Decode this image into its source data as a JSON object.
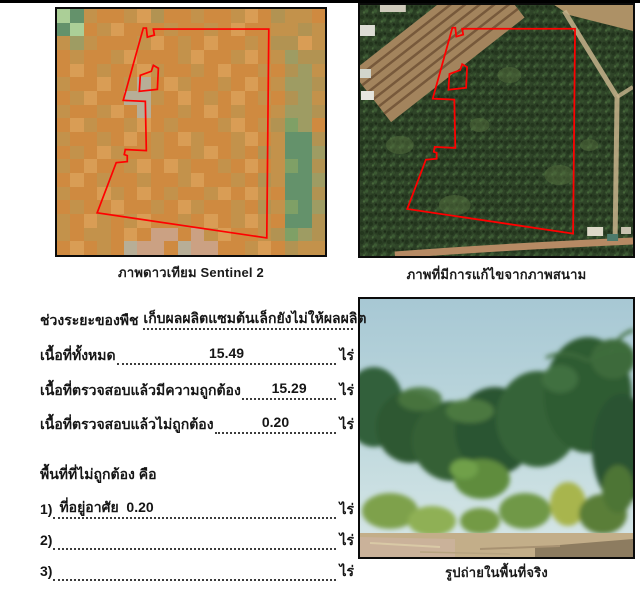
{
  "panels": {
    "satellite": {
      "caption": "ภาพดาวเทียม Sentinel 2",
      "polygon_color": "#ff0000",
      "mosaic": {
        "palette": [
          "#cf8a40",
          "#c3924b",
          "#b29352",
          "#9e9c63",
          "#7fa066",
          "#64926b",
          "#abcf97",
          "#cba183",
          "#b7ae97",
          "#d99d55"
        ],
        "rows": [
          "65100192001001902110",
          "56019000100109001121",
          "13100019010900102291",
          "01001900019001901322",
          "09010091001090010231",
          "10090180910010901332",
          "01900881090109010231",
          "10019080010901001332",
          "09100190100019012430",
          "10010901091001901552",
          "01091001001901021553",
          "10900190910010901452",
          "09010010019001021553",
          "10091090100190910552",
          "01009001091001021453",
          "10910190010901910552",
          "10110907707190012432",
          "09010877087700190211"
        ]
      }
    },
    "aerial": {
      "caption": "ภาพที่มีการแก้ไขจากภาพสนาม",
      "polygon_color": "#ff0000"
    },
    "photo": {
      "caption": "รูปถ่ายในพื้นที่จริง"
    }
  },
  "form": {
    "crop_stage_label": "ช่วงระยะของพืช",
    "crop_stage_value": "เก็บผลผลิตแซมต้นเล็กยังไม่ให้ผลผลิต",
    "lines": [
      {
        "label": "เนื้อที่ทั้งหมด",
        "value": "15.49",
        "unit": "ไร่"
      },
      {
        "label": "เนื้อที่ตรวจสอบแล้วมีความถูกต้อง",
        "value": "15.29",
        "unit": "ไร่"
      },
      {
        "label": "เนื้อที่ตรวจสอบแล้วไม่ถูกต้อง",
        "value": "0.20",
        "unit": "ไร่"
      }
    ],
    "incorrect_header": "พื้นที่ที่ไม่ถูกต้อง คือ",
    "incorrect_items": [
      {
        "no": "1)",
        "value": "ที่อยู่อาศัย  0.20",
        "unit": "ไร่"
      },
      {
        "no": "2)",
        "value": "",
        "unit": "ไร่"
      },
      {
        "no": "3)",
        "value": "",
        "unit": "ไร่"
      }
    ]
  }
}
